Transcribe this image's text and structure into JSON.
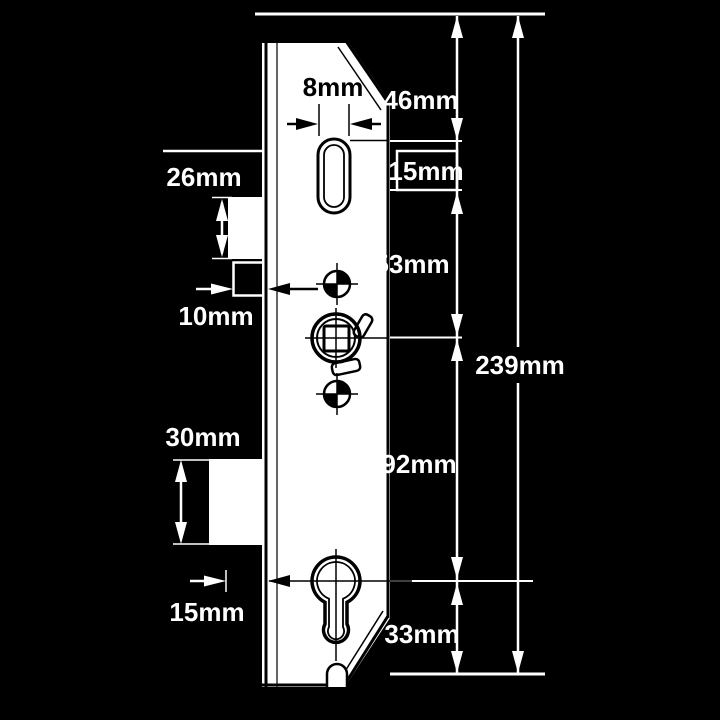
{
  "diagram": {
    "description": "Technical dimension drawing of a multipoint door lock gearbox, front elevation, white linework on black background",
    "unit": "mm",
    "labels": {
      "slot_width": "8mm",
      "top_to_latch_slot": "46mm",
      "latch_slot_height": "15mm",
      "latch_slot_to_spindle": "53mm",
      "spindle_to_cylinder": "92mm",
      "cylinder_to_bottom": "33mm",
      "overall_height": "239mm",
      "latch_height": "26mm",
      "latch_projection": "10mm",
      "deadbolt_height": "30mm",
      "deadbolt_projection": "15mm"
    },
    "colors": {
      "background": "#000000",
      "plate": "#ffffff",
      "plate_ink": "#000000",
      "annotation": "#ffffff"
    }
  }
}
